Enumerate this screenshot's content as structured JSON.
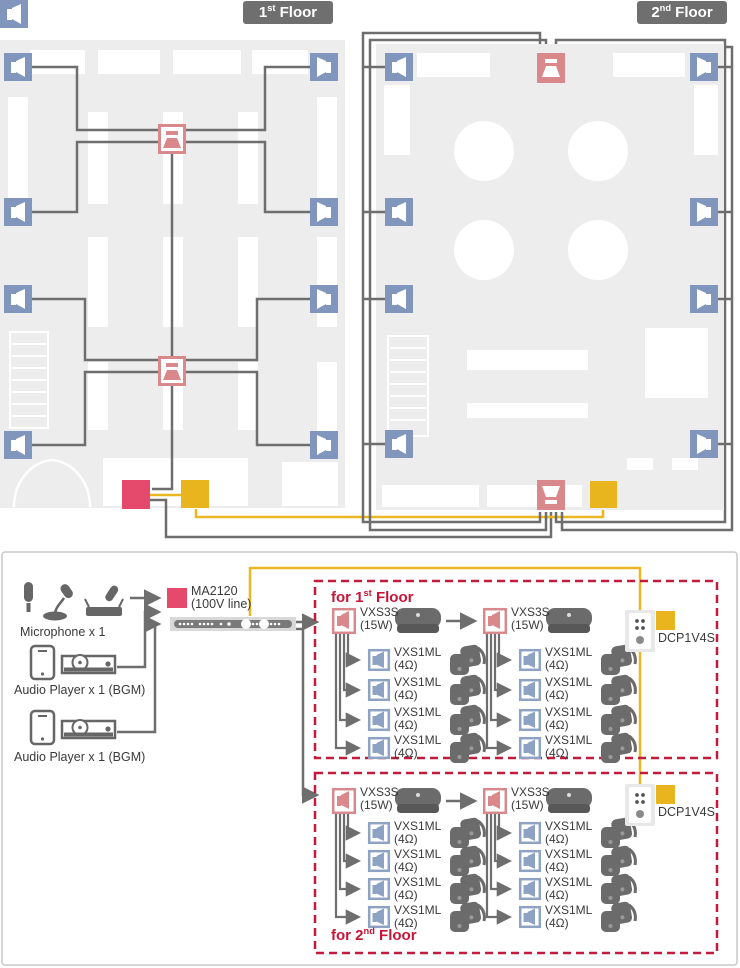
{
  "floor_badges": {
    "first": {
      "pre": "1",
      "sup": "st",
      "post": " Floor"
    },
    "second": {
      "pre": "2",
      "sup": "nd",
      "post": " Floor"
    }
  },
  "sources": {
    "microphone": "Microphone x 1",
    "audio_player_1": "Audio Player x 1 (BGM)",
    "audio_player_2": "Audio Player x 1 (BGM)"
  },
  "amplifier": {
    "model": "MA2120",
    "note": "(100V line)"
  },
  "zones": {
    "first": {
      "pre": "for 1",
      "sup": "st",
      "post": " Floor"
    },
    "second": {
      "pre": "for 2",
      "sup": "nd",
      "post": " Floor"
    }
  },
  "products": {
    "vxs3s": {
      "name": "VXS3S",
      "spec": "(15W)"
    },
    "vxs1ml": {
      "name": "VXS1ML",
      "spec": "(4Ω)"
    },
    "dcp": {
      "name": "DCP1V4S"
    }
  },
  "icons": {
    "wall-speaker-icon": "blue square with speaker glyph",
    "ceiling-speaker-icon": "pink square with ceiling speaker glyph",
    "amp-box": "red square (MA2120)",
    "controller-box": "yellow square (DCP1V4S)",
    "microphone-icon": "handheld, gooseneck and wireless mics",
    "audio-player-icon": "smartphone and CD deck",
    "amp-front-panel": "rack strip with knobs",
    "wall-controller-plate": "white wall plate with buttons and knob",
    "surface-speaker-photo": "dark rounded speaker",
    "multi-speaker-photo": "stack of small dark speakers"
  },
  "colors": {
    "speaker_blue": "#8096bd",
    "ceiling_pink": "#d9888b",
    "amp_red": "#e5496b",
    "controller_yellow": "#e9b51f",
    "wire_gray": "#6e6e6e",
    "wire_yellow": "#eab723",
    "zone_border_red": "#c21b3c",
    "floor_bg": "#ededed",
    "badge_gray": "#6f6f6f"
  }
}
